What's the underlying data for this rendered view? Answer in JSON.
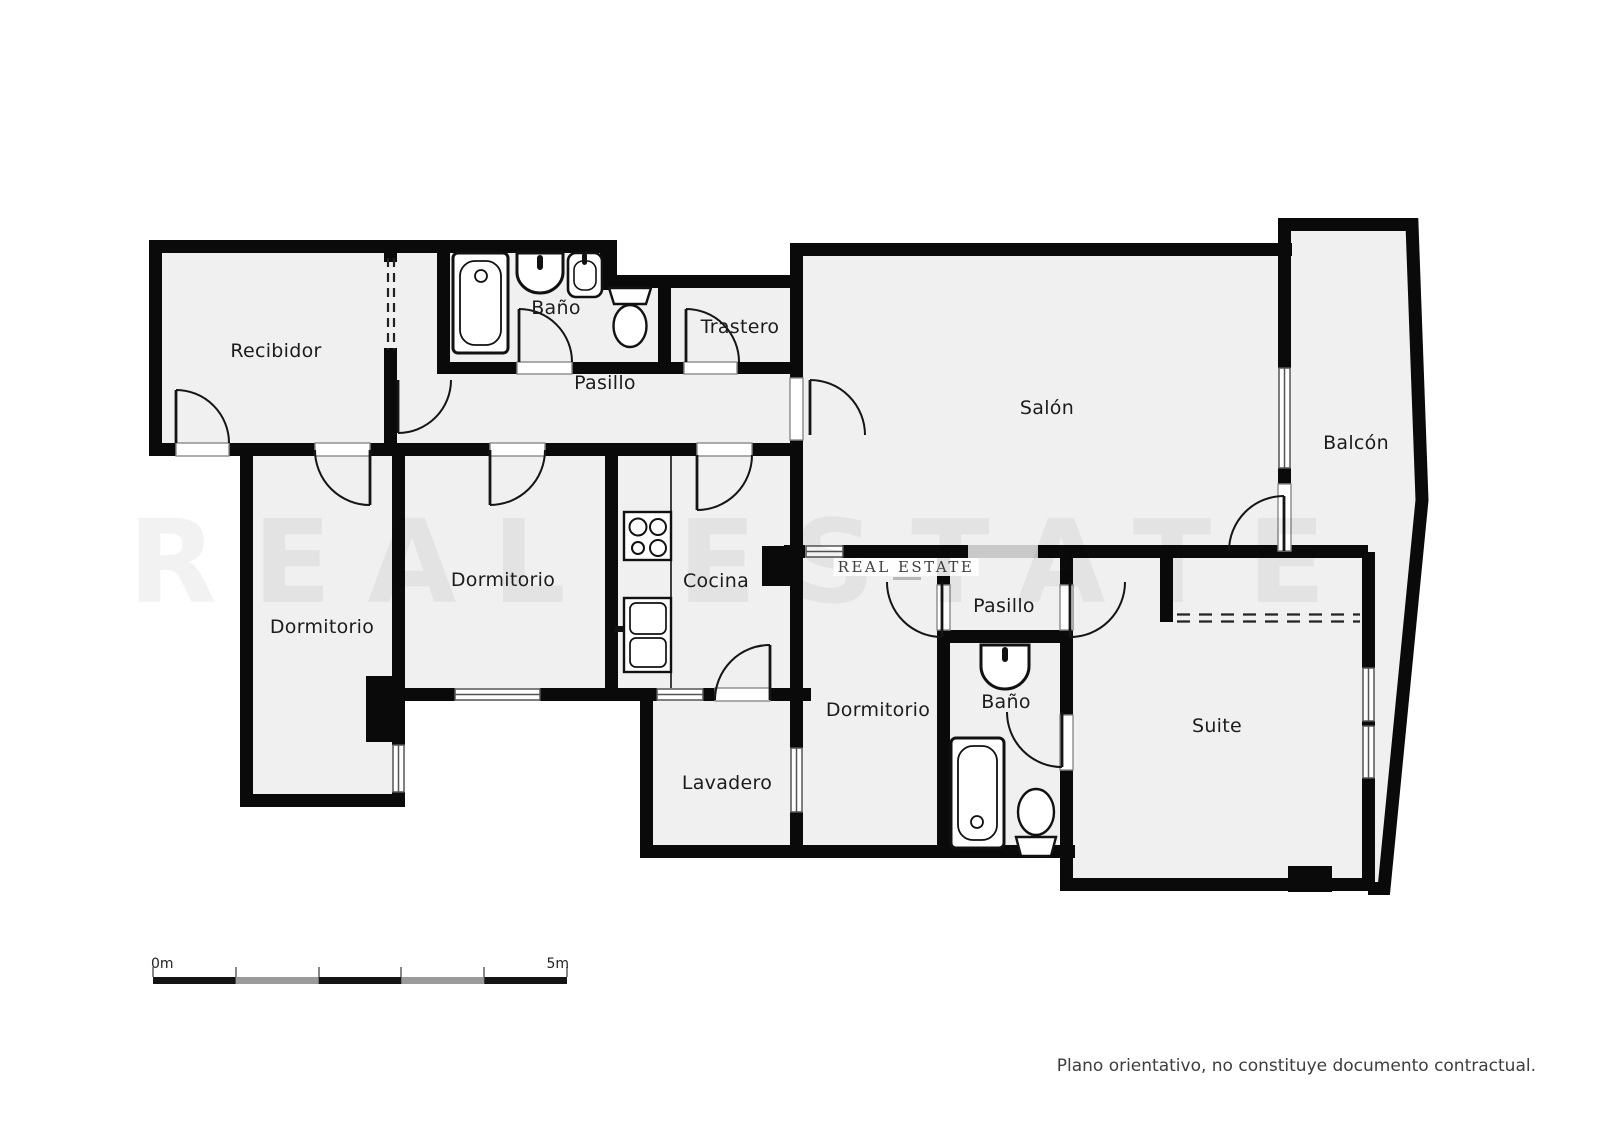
{
  "rooms": [
    {
      "id": "recibidor",
      "label": "Recibidor"
    },
    {
      "id": "bano-1",
      "label": "Baño"
    },
    {
      "id": "trastero",
      "label": "Trastero"
    },
    {
      "id": "pasillo-1",
      "label": "Pasillo"
    },
    {
      "id": "salon",
      "label": "Salón"
    },
    {
      "id": "balcon",
      "label": "Balcón"
    },
    {
      "id": "dormitorio-1",
      "label": "Dormitorio"
    },
    {
      "id": "dormitorio-2",
      "label": "Dormitorio"
    },
    {
      "id": "cocina",
      "label": "Cocina"
    },
    {
      "id": "lavadero",
      "label": "Lavadero"
    },
    {
      "id": "dormitorio-3",
      "label": "Dormitorio"
    },
    {
      "id": "pasillo-2",
      "label": "Pasillo"
    },
    {
      "id": "bano-2",
      "label": "Baño"
    },
    {
      "id": "suite",
      "label": "Suite"
    }
  ],
  "scale_bar": {
    "start_label": "0m",
    "end_label": "5m",
    "segments": 5,
    "segment_colors": [
      "#141414",
      "#9a9a9a",
      "#141414",
      "#9a9a9a",
      "#141414"
    ]
  },
  "watermark": {
    "brand": "REAL ESTATE"
  },
  "footer": {
    "disclaimer": "Plano orientativo, no constituye documento contractual."
  },
  "colors": {
    "wall": "#0a0a0a",
    "floor": "#f0f0f0",
    "opening_highlight": "#c9c9c9",
    "door_arc": "#151515",
    "window_frame": "#555555"
  },
  "fixtures": [
    "bathtub",
    "washbasin",
    "washbasin",
    "toilet",
    "stove",
    "kitchen-cabinet",
    "washbasin",
    "bathtub",
    "toilet"
  ]
}
